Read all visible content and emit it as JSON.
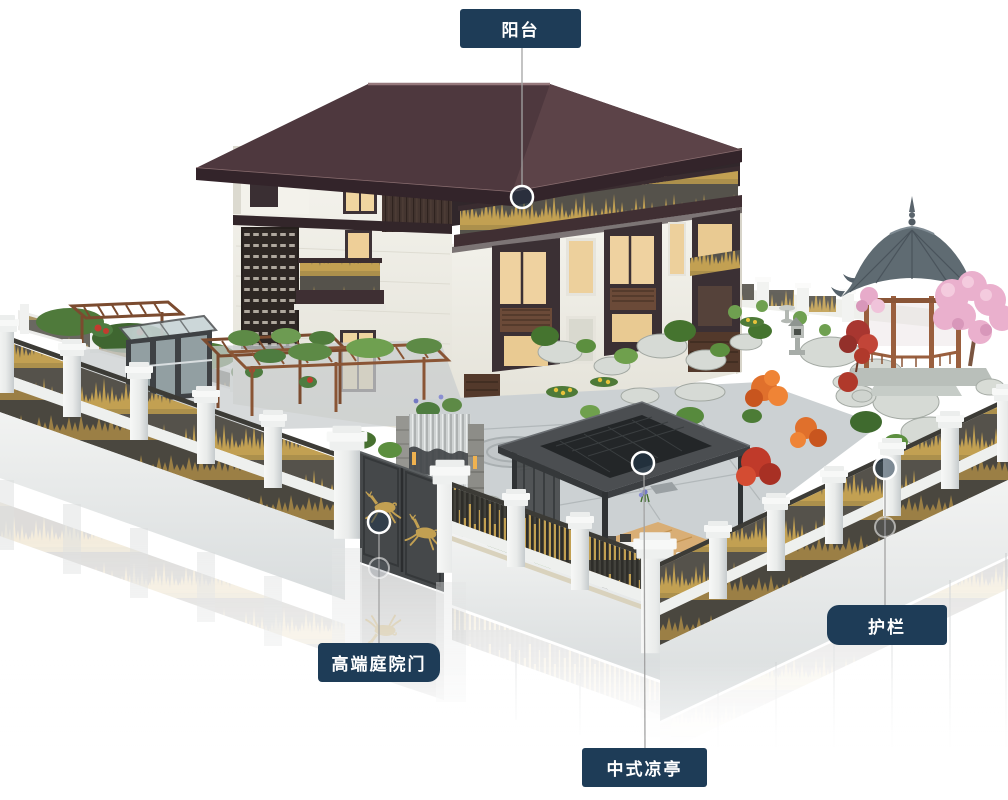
{
  "callouts": {
    "balcony": {
      "label": "阳台"
    },
    "courtyard_gate": {
      "label": "高端庭院门"
    },
    "chinese_pavilion": {
      "label": "中式凉亭"
    },
    "guardrail": {
      "label": "护栏"
    }
  },
  "icons": {
    "deer": "leaping-deer-icon",
    "marker": "ring-hotspot-marker"
  },
  "colors": {
    "label_bg": "#1e3c57",
    "label_fg": "#ffffff",
    "callout_line": "#a3a3a3",
    "marker_fill": "#23384d",
    "marker_ring": "#ffffff",
    "accent_gold": "#c2a052",
    "gold_deep": "#b5954d",
    "roof": "#4e383e",
    "wood_dark": "#463631",
    "fence_white": "#f1f2f1",
    "panel_dark": "#55524b",
    "gazebo_roof": "#5f6b72",
    "gazebo_wood": "#9a5f3e",
    "pavilion_dark": "#4b4e51",
    "deck_wood": "#d9ae75",
    "foliage": "#5c8f3f",
    "blossom_pink": "#eab0cd",
    "maple_orange": "#e0702c",
    "maple_red": "#b0392b"
  }
}
